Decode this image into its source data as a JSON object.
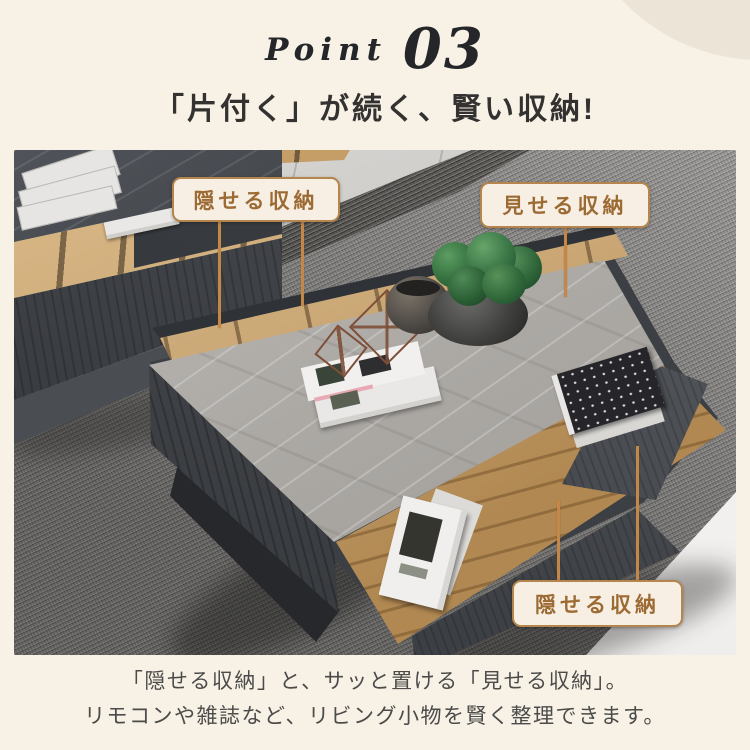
{
  "header": {
    "point_label": "Point",
    "point_number": "03",
    "heading": "「片付く」が続く、賢い収納!"
  },
  "photo": {
    "callouts": [
      {
        "id": "hide-top",
        "text": "隠せる収納"
      },
      {
        "id": "show",
        "text": "見せる収納"
      },
      {
        "id": "hide-bottom",
        "text": "隠せる収納"
      }
    ]
  },
  "caption": {
    "line1": "「隠せる収納」と、サッと置ける「見せる収納」。",
    "line2": "リモコンや雑誌など、リビング小物を賢く整理できます。"
  },
  "colors": {
    "background": "#f8f1e6",
    "decor_circle": "#ece4d7",
    "callout_border": "#b5854e",
    "callout_text": "#9c6a33",
    "callout_line": "#c4874a",
    "heading_text": "#333231",
    "caption_text": "#4b4b49",
    "point_text": "#24262a"
  }
}
